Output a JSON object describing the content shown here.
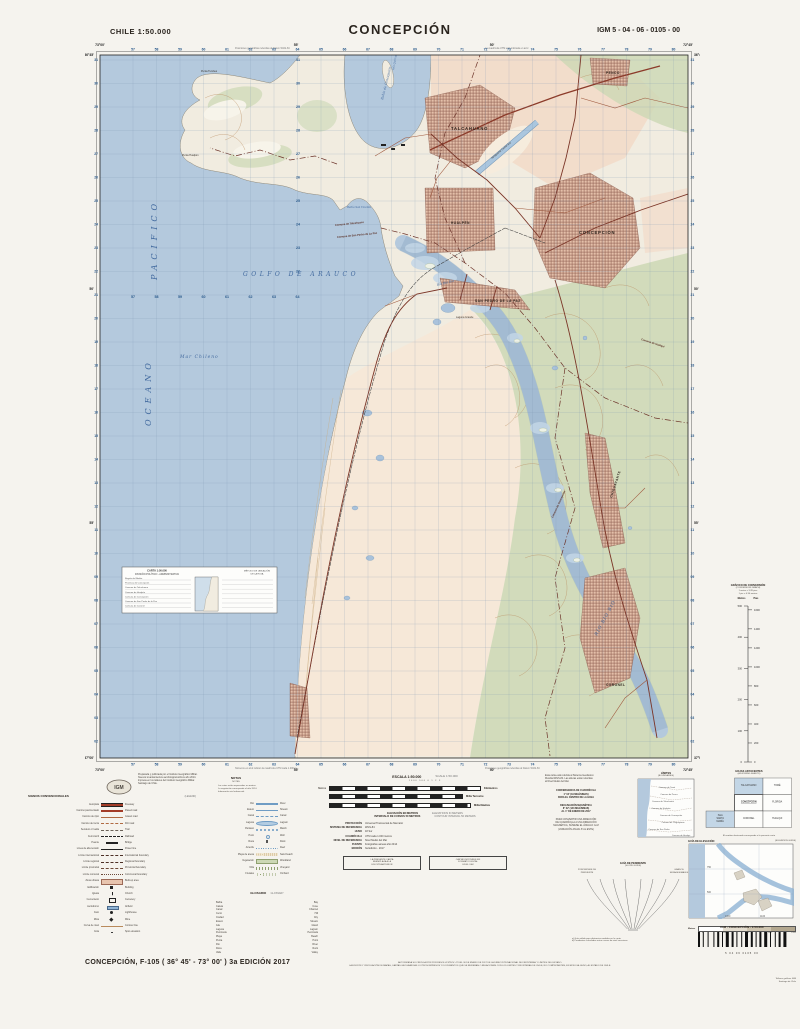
{
  "header": {
    "country_scale": "CHILE  1:50.000",
    "title": "CONCEPCIÓN",
    "sheet_code": "IGM 5 - 04 - 06 - 0105 - 00"
  },
  "map": {
    "lat_labels": [
      "36°45'",
      "50'",
      "55'",
      "37°00'"
    ],
    "lon_labels": [
      "73°00'",
      "55'",
      "50'",
      "72°45'"
    ],
    "grid": {
      "eastings": [
        "57",
        "58",
        "59",
        "60",
        "61",
        "62",
        "63",
        "64",
        "65",
        "66",
        "67",
        "68",
        "69",
        "70",
        "71",
        "72",
        "73",
        "74",
        "75",
        "76",
        "77",
        "78",
        "79",
        "80"
      ],
      "northings": [
        "31",
        "30",
        "29",
        "28",
        "27",
        "26",
        "25",
        "24",
        "23",
        "22",
        "21",
        "20",
        "19",
        "18",
        "17",
        "16",
        "15",
        "14",
        "13",
        "12",
        "11",
        "10",
        "09",
        "08",
        "07",
        "06",
        "05",
        "04",
        "03",
        "02"
      ]
    },
    "notes": {
      "top_left": "Posiciones geográficas referidas al Datum WGS-84",
      "top_right": "La cuadrícula UTM está indicada en azul",
      "bottom_left": "Números en azul indican la cuadrícula UTM cada 1.000 m",
      "bottom_right": "Posiciones geográficas referidas al Datum WGS-84"
    },
    "labels": {
      "places": [
        {
          "t": "PACIFICO",
          "x": 72,
          "y": 242,
          "r": -90,
          "c": "oc"
        },
        {
          "t": "OCEANO",
          "x": 66,
          "y": 388,
          "r": -90,
          "c": "oc"
        },
        {
          "t": "Mar Chileno",
          "x": 95,
          "y": 320,
          "r": 0,
          "c": "hy4"
        },
        {
          "t": "GOLFO  DE  ARAUCO",
          "x": 158,
          "y": 238,
          "r": 0,
          "c": "hy5"
        },
        {
          "t": "RÍO  BIO  BIO",
          "x": 512,
          "y": 598,
          "r": -62,
          "c": "hy4"
        },
        {
          "t": "Río Bio Bio",
          "x": 352,
          "y": 248,
          "r": -14,
          "c": "hy3"
        },
        {
          "t": "Bahía de Concepción",
          "x": 298,
          "y": 62,
          "r": -76,
          "c": "hy3"
        },
        {
          "t": "Bahía San Vicente",
          "x": 262,
          "y": 170,
          "r": 0,
          "c": "hy2"
        },
        {
          "t": "Isla Quiriquina",
          "x": 309,
          "y": 32,
          "r": -80,
          "c": "hy2"
        },
        {
          "t": "TALCAHUANO",
          "x": 366,
          "y": 92,
          "r": 0,
          "c": "ct"
        },
        {
          "t": "HUALPÉN",
          "x": 366,
          "y": 186,
          "r": 0,
          "c": "ct2"
        },
        {
          "t": "CONCEPCIÓN",
          "x": 494,
          "y": 196,
          "r": 0,
          "c": "ct"
        },
        {
          "t": "SAN PEDRO DE LA PAZ",
          "x": 390,
          "y": 264,
          "r": 0,
          "c": "ct2"
        },
        {
          "t": "CHIGUAYANTE",
          "x": 527,
          "y": 460,
          "r": -72,
          "c": "ct2"
        },
        {
          "t": "CORONEL",
          "x": 521,
          "y": 648,
          "r": 0,
          "c": "ct2"
        },
        {
          "t": "PENCO",
          "x": 521,
          "y": 36,
          "r": 0,
          "c": "ct2"
        },
        {
          "t": "Aeropuerto Carriel Sur",
          "x": 407,
          "y": 121,
          "r": -40,
          "c": "sm"
        },
        {
          "t": "Punta Tumbes",
          "x": 116,
          "y": 34,
          "r": 0,
          "c": "sm"
        },
        {
          "t": "Punta Hualpén",
          "x": 97,
          "y": 118,
          "r": 0,
          "c": "sm"
        },
        {
          "t": "Laguna Grande",
          "x": 371,
          "y": 280,
          "r": 0,
          "c": "sm"
        },
        {
          "t": "Comuna de Talcahuano",
          "x": 250,
          "y": 188,
          "r": -6,
          "c": "bd"
        },
        {
          "t": "Comuna de San Pedro de La Paz",
          "x": 252,
          "y": 200,
          "r": -6,
          "c": "bd"
        },
        {
          "t": "Comuna de Concepción",
          "x": 468,
          "y": 480,
          "r": -65,
          "c": "bd"
        },
        {
          "t": "Comuna de Hualqui",
          "x": 556,
          "y": 302,
          "r": 18,
          "c": "bd"
        }
      ]
    },
    "inset": {
      "t1": "CARTA 1:50.000",
      "t2": "DIVISIÓN POLÍTICO - ADMINISTRATIVA",
      "r1": "MÉTODO DE UBICACIÓN",
      "r2": "DE LA HOJA",
      "rows": [
        "Región del Biobío",
        "Provincia de Concepción",
        "Comuna de Talcahuano",
        "Comuna de Hualpén",
        "Comuna de Concepción",
        "Comuna de San Pedro de la Paz",
        "Comuna de Coronel"
      ]
    }
  },
  "legend": {
    "title": "SIGNOS CONVENCIONALES",
    "title_en": "(LEGEND)",
    "col1": [
      {
        "es": "Autopista",
        "en": "Freeway",
        "sym": "road1"
      },
      {
        "es": "Camino pavimentado",
        "en": "Paved road",
        "sym": "road2"
      },
      {
        "es": "Camino de ripio",
        "en": "Gravel road",
        "sym": "road3"
      },
      {
        "es": "Camino de tierra",
        "en": "Dirt road",
        "sym": "road4"
      },
      {
        "es": "Sendero o huella",
        "en": "Trail",
        "sym": "trail"
      },
      {
        "es": "Ferrocarril",
        "en": "Railroad",
        "sym": "rail"
      },
      {
        "es": "Puente",
        "en": "Bridge",
        "sym": "bridge"
      },
      {
        "es": "Línea de alta tensión",
        "en": "Power line",
        "sym": "power"
      },
      {
        "es": "Límite internacional",
        "en": "International boundary",
        "sym": "b1"
      },
      {
        "es": "Límite regional",
        "en": "Regional boundary",
        "sym": "b2"
      },
      {
        "es": "Límite provincial",
        "en": "Provincial boundary",
        "sym": "b3"
      },
      {
        "es": "Límite comunal",
        "en": "Communal boundary",
        "sym": "b4"
      },
      {
        "es": "Zona urbana",
        "en": "Built-up area",
        "sym": "urb"
      },
      {
        "es": "Edificación",
        "en": "Building",
        "sym": "bld"
      },
      {
        "es": "Iglesia",
        "en": "Church",
        "sym": "chu"
      },
      {
        "es": "Cementerio",
        "en": "Cemetery",
        "sym": "cem"
      },
      {
        "es": "Aeródromo",
        "en": "Airfield",
        "sym": "air"
      },
      {
        "es": "Faro",
        "en": "Lighthouse",
        "sym": "faro"
      },
      {
        "es": "Mina",
        "en": "Mine",
        "sym": "mina"
      },
      {
        "es": "Curva de nivel",
        "en": "Contour line",
        "sym": "cont"
      },
      {
        "es": "Cota",
        "en": "Spot elevation",
        "sym": "cota"
      }
    ],
    "col2": [
      {
        "es": "Río",
        "en": "River",
        "sym": "riv"
      },
      {
        "es": "Estero",
        "en": "Stream",
        "sym": "est"
      },
      {
        "es": "Canal",
        "en": "Canal",
        "sym": "can"
      },
      {
        "es": "Laguna",
        "en": "Lagoon",
        "sym": "lag"
      },
      {
        "es": "Pantano",
        "en": "Marsh",
        "sym": "pan"
      },
      {
        "es": "Pozo",
        "en": "Well",
        "sym": "pozo"
      },
      {
        "es": "Roca",
        "en": "Rock",
        "sym": "roca"
      },
      {
        "es": "Arrecife",
        "en": "Reef",
        "sym": "arr"
      },
      {
        "es": "Playa de arena",
        "en": "Sand beach",
        "sym": "arena"
      },
      {
        "es": "Vegetación",
        "en": "Woodland",
        "sym": "veg"
      },
      {
        "es": "Viña",
        "en": "Vineyard",
        "sym": "vina"
      },
      {
        "es": "Frutales",
        "en": "Orchard",
        "sym": "fru"
      }
    ],
    "glossary_title": "GLOSARIO",
    "glossary_title_en": "GLOSSARY",
    "glossary": [
      [
        "Bahía",
        "Bay"
      ],
      [
        "Caleta",
        "Cove"
      ],
      [
        "Canal",
        "Channel"
      ],
      [
        "Cerro",
        "Hill"
      ],
      [
        "Ciudad",
        "City"
      ],
      [
        "Estero",
        "Stream"
      ],
      [
        "Isla",
        "Island"
      ],
      [
        "Laguna",
        "Lagoon"
      ],
      [
        "Península",
        "Peninsula"
      ],
      [
        "Playa",
        "Beach"
      ],
      [
        "Punta",
        "Point"
      ],
      [
        "Río",
        "River"
      ],
      [
        "Roca",
        "Rock"
      ],
      [
        "Valle",
        "Valley"
      ]
    ]
  },
  "credits": {
    "prep_lines": [
      "Preparada y publicada por el Instituto Geográfico Militar.",
      "Nuevos levantamientos aerofotogramétricos año 2014.",
      "Impresa en los talleres del Instituto Geográfico Militar.",
      "Santiago de Chile."
    ],
    "logo": "IGM",
    "notas_title": "NOTAS",
    "notas_title_en": "NOTES",
    "notas_lines": [
      "Las cotas están expresadas en metros.",
      "La vegetación corresponde al año 2014.",
      "Información vial referencial."
    ]
  },
  "scale": {
    "title": "ESCALA 1:50.000",
    "title_en": "SCALE 1:50.000",
    "numbers": "1000        500          0                       1                       2                       3",
    "rows": [
      {
        "left": "Metros",
        "right": "Kilómetros"
      },
      {
        "left": "",
        "right": "Milla Terrestre"
      },
      {
        "left": "",
        "right": "Milla Náutica"
      }
    ],
    "elev": "ELEVACIÓN EN METROS",
    "elev_en": "ELEVATIONS IN METERS",
    "interval": "INTERVALO DE CURVAS 50 METROS",
    "interval_en": "CONTOUR INTERVAL 50 METERS"
  },
  "metadata": [
    {
      "k": "PROYECCIÓN",
      "v": "Universal Transversal de Mercator"
    },
    {
      "k": "SISTEMA DE REFERENCIA",
      "v": "WGS-84"
    },
    {
      "k": "HUSO",
      "v": "18 Sur"
    },
    {
      "k": "CUADRÍCULA",
      "v": "UTM cada 1.000 metros"
    },
    {
      "k": "NIVEL DE REFERENCIA",
      "v": "Nivel Medio del Mar"
    },
    {
      "k": "FUENTE",
      "v": "Fotografías aéreas año 2014"
    },
    {
      "k": "EDICIÓN",
      "v": "3a Edición - 2017"
    }
  ],
  "boxes": {
    "box1": [
      "LA PRESENTE CARTA",
      "REEMPLAZA A LA",
      "EDICIÓN ANTERIOR"
    ],
    "box2": [
      "CARTA DISPONIBLE EN",
      "FORMATO DIGITAL",
      "EN EL IGM"
    ]
  },
  "geo_notes": {
    "ref_lines": [
      "Esta carta está referida al Sistema Geodésico",
      "Mundial WGS-84. Las alturas están referidas",
      "al Nivel Medio del Mar."
    ],
    "convergencia": [
      "CONVERGENCIA DE CUADRÍCULA",
      "1° 04' (19 MILÉSIMAS)",
      "PARA EL CENTRO DE LA HOJA"
    ],
    "declinacion": [
      "DECLINACIÓN MAGNÉTICA",
      "8° 02' (143 MILÉSIMAS)",
      "AL 1° DE ENERO DE 2017"
    ],
    "convertir": [
      "PARA CONVERTIR UNA DIRECCIÓN",
      "DE CUADRÍCULA A UNA DIRECCIÓN",
      "MAGNÉTICA, SÚMESE EL ÁNGULO G-M",
      "(VARIACIÓN ANUAL 8' AL ESTE)"
    ]
  },
  "limites": {
    "title": "LÍMITES",
    "sub": "(BOUNDARIES)",
    "names": [
      {
        "t": "Comuna de Tomé",
        "x": 30,
        "y": 10
      },
      {
        "t": "Comuna de Penco",
        "x": 32,
        "y": 17
      },
      {
        "t": "Comuna de Talcahuano",
        "x": 26,
        "y": 24
      },
      {
        "t": "Comuna de Hualpén",
        "x": 24,
        "y": 31
      },
      {
        "t": "Comuna de Concepción",
        "x": 34,
        "y": 38
      },
      {
        "t": "Comuna de Chiguayante",
        "x": 36,
        "y": 45
      },
      {
        "t": "Comuna de San Pedro",
        "x": 22,
        "y": 52
      },
      {
        "t": "Comuna de Coronel",
        "x": 24,
        "y": 62
      },
      {
        "t": "Comuna de Hualqui",
        "x": 44,
        "y": 58
      }
    ]
  },
  "adjacent": {
    "title": "HOJAS ADYACENTES",
    "sub": "(ADJOINING SHEETS)",
    "caption": "El nombre destacado corresponde a la presente carta",
    "cells": [
      {
        "c": 1,
        "r": 0,
        "t": "TALCAHUANO",
        "blue": true
      },
      {
        "c": 2,
        "r": 0,
        "t": "TOMÉ",
        "blue": false
      },
      {
        "c": 1,
        "r": 1,
        "t": "CONCEPCIÓN",
        "cur": true
      },
      {
        "c": 2,
        "r": 1,
        "t": "FLORIDA",
        "blue": false
      },
      {
        "c": 0,
        "r": 2,
        "t": "ISLA SANTA MARÍA",
        "blue": true
      },
      {
        "c": 1,
        "r": 2,
        "t": "CORONEL",
        "blue": false
      },
      {
        "c": 2,
        "r": 2,
        "t": "HUALQUI",
        "blue": false
      }
    ]
  },
  "pendiente": {
    "title": "GUÍA DE PENDIENTE",
    "sub": "(SLOPE GUIDE)",
    "left1": "PORCENTAJE DE",
    "left2": "PENDIENTE",
    "right1": "GRADOS",
    "right2": "SEXAGESIMALES",
    "notes": [
      "a) Guía válida para distancias medidas en la carta.",
      "b) Pendientes calculadas entre curvas de nivel sucesivas."
    ]
  },
  "elev_guide": {
    "title": "GUÍA DE ELEVACIÓN",
    "sub": "(ELEVATION GUIDE)",
    "scale_vals": [
      "0",
      "150",
      "300",
      "600",
      "1200"
    ],
    "unit": "Metros"
  },
  "conversion": {
    "title": "GRÁFICO DE CONVERSIÓN",
    "sub": "(CONVERSION GRAPH)",
    "note1": "1 metro = 3.28 pies",
    "note2": "1 pie = 0.30 metros",
    "col_m": "Metros",
    "col_p": "Pies",
    "metros": [
      0,
      100,
      200,
      300,
      400,
      500
    ],
    "pies": [
      0,
      200,
      400,
      600,
      800,
      1000,
      1200,
      1400,
      1600
    ]
  },
  "circulation": [
    "AUTORIZADA SU CIRCULACIÓN POR RESOLUCIÓN N° 47 DEL 30 DE ENERO DE 2017 DE LA DIRECCIÓN NACIONAL DE FRONTERAS Y LÍMITES DEL ESTADO.",
    "LA EDICIÓN Y CIRCULACIÓN DE MAPAS, CARTAS GEOGRÁFICAS U OTROS IMPRESOS Y DOCUMENTOS QUE SE REFIERAN O RELACIONEN CON LOS LÍMITES Y FRONTERAS DE CHILE, NO COMPROMETEN, EN MODO ALGUNO, AL ESTADO DE CHILE."
  ],
  "footer": {
    "edition": "CONCEPCIÓN, F-105 ( 36° 45' - 73° 00' ) 3a EDICIÓN 2017",
    "igm_line": "IGM  -  CONCEPCIÓN  -  1:50.000",
    "barcode_digits": "5      04      06      0105      00",
    "imprint": [
      "Talleres gráficos IGM",
      "Santiago de Chile"
    ]
  },
  "colors": {
    "ocean": "#b4c9dd",
    "land": "#f1ece0",
    "fields": "#f2dcc9",
    "urban": "#e3bfa9",
    "urban_line": "#8a574a",
    "green": "#ccd8b4",
    "road": "#7b3527",
    "grid": "#7f9ab5",
    "contour": "#b98a5c"
  }
}
